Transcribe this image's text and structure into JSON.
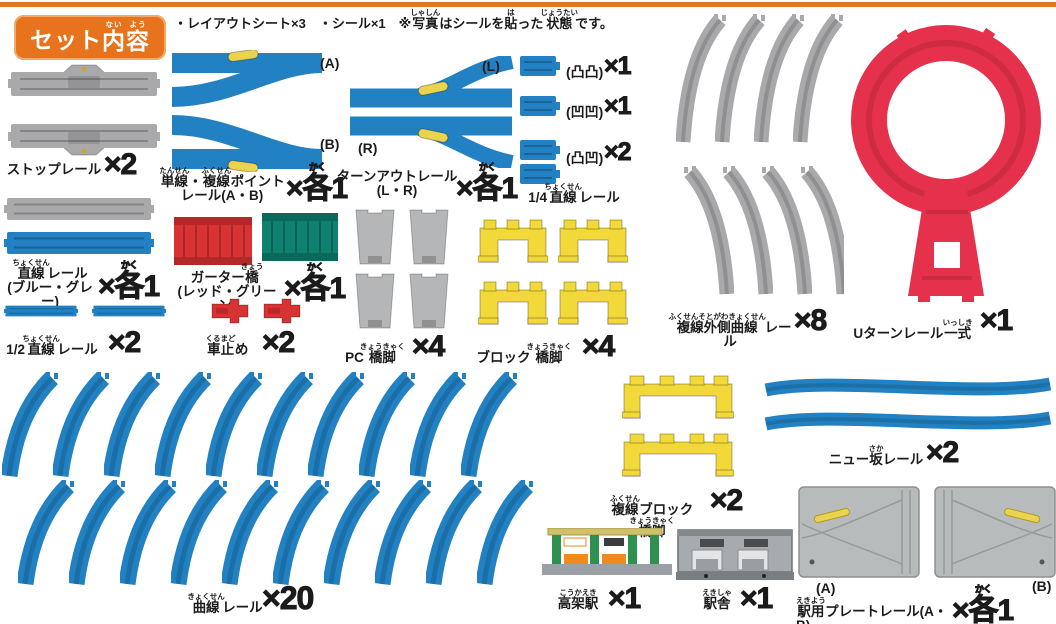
{
  "header": {
    "badge": [
      {
        "t": "セット"
      },
      {
        "t": "内",
        "r": "ない"
      },
      {
        "t": "容",
        "r": "よう"
      }
    ]
  },
  "note": [
    {
      "t": "・レイアウトシート×3　・シール×1　※"
    },
    {
      "t": "写真",
      "r": "しゃしん"
    },
    {
      "t": "はシールを"
    },
    {
      "t": "貼",
      "r": "は"
    },
    {
      "t": "った"
    },
    {
      "t": "状態",
      "r": "じょうたい"
    },
    {
      "t": "です。"
    }
  ],
  "items": [
    {
      "id": "stop-rail",
      "label": [
        {
          "t": "ストップレール"
        }
      ],
      "count": [
        {
          "t": "×2"
        }
      ]
    },
    {
      "id": "point-rail",
      "label": [
        {
          "t": "単線",
          "r": "たんせん"
        },
        {
          "t": "・"
        },
        {
          "t": "複線",
          "r": "ふくせん"
        },
        {
          "t": "ポイント"
        },
        {
          "br": true
        },
        {
          "t": "レール(A・B)"
        }
      ],
      "count": [
        {
          "t": "×"
        },
        {
          "t": "各",
          "r": "かく"
        },
        {
          "t": "1"
        }
      ],
      "tags": [
        "(A)",
        "(B)"
      ]
    },
    {
      "id": "turnout-rail",
      "label": [
        {
          "t": "ターンアウトレール"
        },
        {
          "br": true
        },
        {
          "t": "(L・R)"
        }
      ],
      "count": [
        {
          "t": "×"
        },
        {
          "t": "各",
          "r": "かく"
        },
        {
          "t": "1"
        }
      ],
      "tags": [
        "(L)",
        "(R)"
      ]
    },
    {
      "id": "quarter-straight-rail",
      "label": [
        {
          "t": "1/4"
        },
        {
          "t": "直線",
          "r": "ちょくせん"
        },
        {
          "t": "レール"
        }
      ],
      "variants": [
        {
          "tag": "(凸凸)",
          "count": "×1"
        },
        {
          "tag": "(凹凹)",
          "count": "×1"
        },
        {
          "tag": "(凸凹)",
          "count": "×2"
        }
      ]
    },
    {
      "id": "double-outer-curve-rail",
      "label": [
        {
          "t": "複線外側曲線",
          "r": "ふくせんそとがわきょくせん"
        },
        {
          "t": "レール"
        }
      ],
      "count": [
        {
          "t": "×8"
        }
      ]
    },
    {
      "id": "u-turn-rail",
      "label": [
        {
          "t": "Uターンレール"
        },
        {
          "t": "一式",
          "r": "いっしき"
        }
      ],
      "count": [
        {
          "t": "×1"
        }
      ]
    },
    {
      "id": "straight-rail",
      "label": [
        {
          "t": "直線",
          "r": "ちょくせん"
        },
        {
          "t": "レール"
        },
        {
          "br": true
        },
        {
          "t": "(ブルー・グレー)"
        }
      ],
      "count": [
        {
          "t": "×"
        },
        {
          "t": "各",
          "r": "かく"
        },
        {
          "t": "1"
        }
      ]
    },
    {
      "id": "girder-bridge",
      "label": [
        {
          "t": "ガーター"
        },
        {
          "t": "橋",
          "r": "きょう"
        },
        {
          "br": true
        },
        {
          "t": "(レッド・グリーン)"
        }
      ],
      "count": [
        {
          "t": "×"
        },
        {
          "t": "各",
          "r": "かく"
        },
        {
          "t": "1"
        }
      ]
    },
    {
      "id": "half-straight-rail",
      "label": [
        {
          "t": "1/2"
        },
        {
          "t": "直線",
          "r": "ちょくせん"
        },
        {
          "t": "レール"
        }
      ],
      "count": [
        {
          "t": "×2"
        }
      ]
    },
    {
      "id": "buffer-stop",
      "label": [
        {
          "t": "車止",
          "r": "くるまど"
        },
        {
          "t": "め"
        }
      ],
      "count": [
        {
          "t": "×2"
        }
      ]
    },
    {
      "id": "pc-pier",
      "label": [
        {
          "t": "PC"
        },
        {
          "t": "橋脚",
          "r": "きょうきゃく"
        }
      ],
      "count": [
        {
          "t": "×4"
        }
      ]
    },
    {
      "id": "block-pier",
      "label": [
        {
          "t": "ブロック"
        },
        {
          "t": "橋脚",
          "r": "きょうきゃく"
        }
      ],
      "count": [
        {
          "t": "×4"
        }
      ]
    },
    {
      "id": "curve-rail",
      "label": [
        {
          "t": "曲線",
          "r": "きょくせん"
        },
        {
          "t": "レール"
        }
      ],
      "count": [
        {
          "t": "×20"
        }
      ]
    },
    {
      "id": "double-block-pier",
      "label": [
        {
          "t": "複線",
          "r": "ふくせん"
        },
        {
          "t": "ブロック"
        },
        {
          "t": "橋脚",
          "r": "きょうきゃく"
        }
      ],
      "count": [
        {
          "t": "×2"
        }
      ]
    },
    {
      "id": "new-slope-rail",
      "label": [
        {
          "t": "ニュー"
        },
        {
          "t": "坂",
          "r": "さか"
        },
        {
          "t": "レール"
        }
      ],
      "count": [
        {
          "t": "×2"
        }
      ]
    },
    {
      "id": "elevated-station",
      "label": [
        {
          "t": "高架駅",
          "r": "こうかえき"
        }
      ],
      "count": [
        {
          "t": "×1"
        }
      ]
    },
    {
      "id": "station-house",
      "label": [
        {
          "t": "駅舎",
          "r": "えきしゃ"
        }
      ],
      "count": [
        {
          "t": "×1"
        }
      ]
    },
    {
      "id": "station-plate-rail",
      "label": [
        {
          "t": "駅用",
          "r": "えきよう"
        },
        {
          "t": "プレートレール(A・B)"
        }
      ],
      "count": [
        {
          "t": "×"
        },
        {
          "t": "各",
          "r": "かく"
        },
        {
          "t": "1"
        }
      ],
      "tags": [
        "(A)",
        "(B)"
      ]
    }
  ],
  "colors": {
    "topline": "#e0761f",
    "orange": "#e8731d",
    "blue": "#2181c2",
    "gray": "#a9a9ab",
    "grayLight": "#b5b6b7",
    "red": "#e5314b",
    "red2": "#d93232",
    "green": "#0e8170",
    "yellow": "#f2d838",
    "lever": "#e9d34f"
  }
}
